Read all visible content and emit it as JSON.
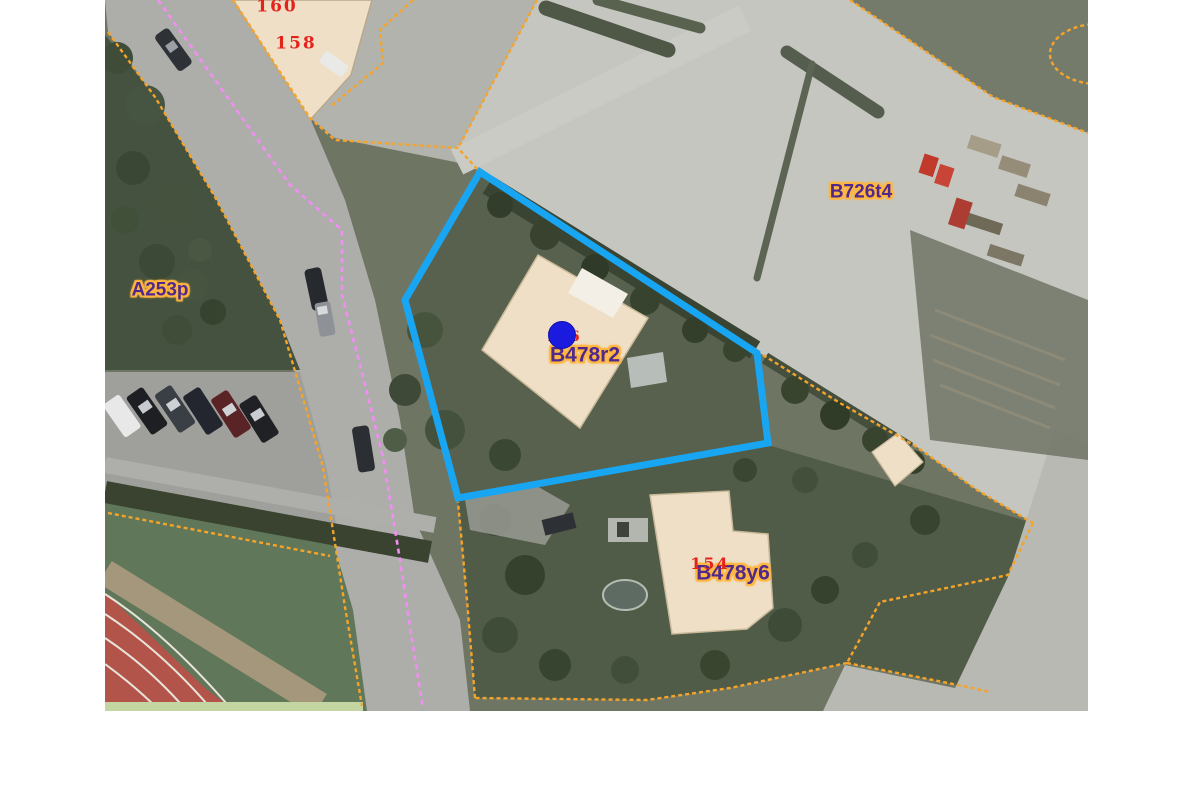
{
  "map": {
    "description": "aerial cadastral map view with parcel boundaries",
    "house_numbers": {
      "n160": "160",
      "n158": "158"
    },
    "parcels": {
      "a253p": {
        "label": "A253p"
      },
      "b726t4": {
        "label": "B726t4"
      },
      "b478r2": {
        "label": "B478r2",
        "house_number": "156",
        "selected": true,
        "marker": "blue-dot"
      },
      "b478y6": {
        "label": "B478y6",
        "house_number": "154"
      }
    },
    "colors": {
      "parcel_boundary": "#f5a42a",
      "secondary_boundary": "#f08ef2",
      "parcel_label_text": "#4f2a8c",
      "parcel_label_halo": "#ffb640",
      "house_number_text": "#e5231d",
      "selected_parcel_outline": "#18a6f2",
      "marker_fill": "#1b1be0",
      "building_fill": "#eedfc6",
      "margin": "#ffffff"
    },
    "features": [
      "curving street with cars",
      "row of parked cars",
      "running track with field",
      "large parking lot",
      "storage yard with pallets and red containers",
      "trees and hedges",
      "four buildings",
      "garden pond"
    ]
  }
}
